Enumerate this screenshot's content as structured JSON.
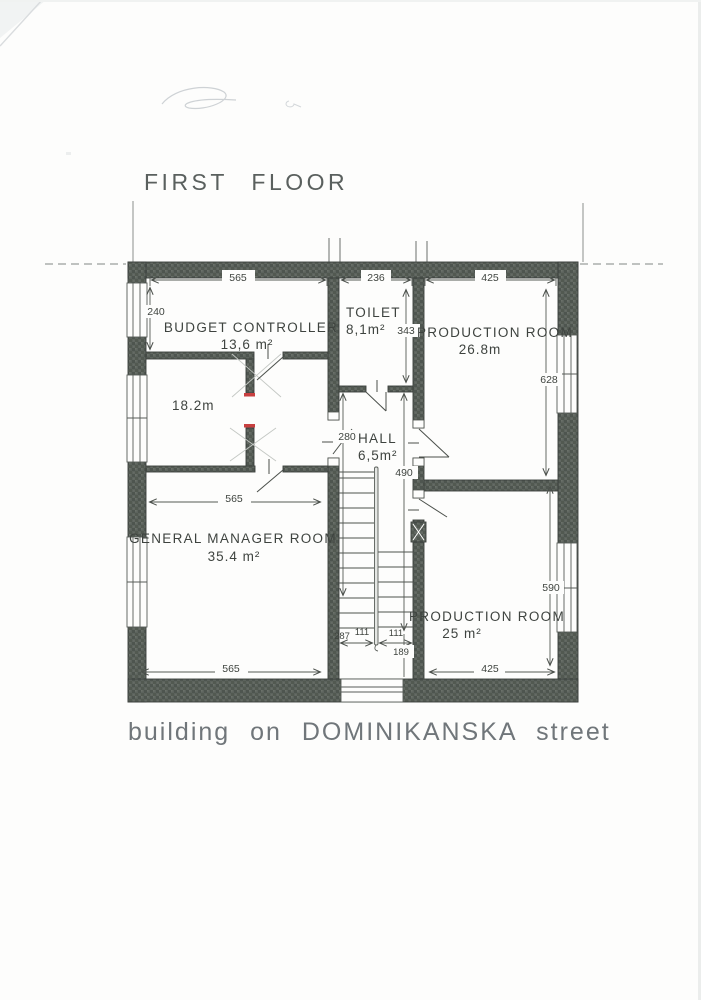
{
  "title": "FIRST FLOOR",
  "caption": "building on DOMINIKANSKA street",
  "rooms": {
    "budget_controller": {
      "name": "BUDGET CONTROLLER",
      "area": "13,6 m²"
    },
    "toilet": {
      "name": "TOILET",
      "area": "8,1m²"
    },
    "production_top": {
      "name": "PRODUCTION ROOM",
      "area": "26.8m"
    },
    "middle_room": {
      "area": "18.2m"
    },
    "hall": {
      "name": "HALL",
      "area": "6,5m²"
    },
    "general_manager": {
      "name": "GENERAL MANAGER ROOM",
      "area": "35.4 m²"
    },
    "production_bottom": {
      "name": "PRODUCTION ROOM",
      "area": "25 m²"
    }
  },
  "dimensions": {
    "top_left": "565",
    "top_middle": "236",
    "top_right": "425",
    "left_upper": "240",
    "toilet_height": "343",
    "right_upper": "628",
    "hall_left": "280",
    "hall_right": "490",
    "gm_width": "565",
    "right_lower": "590",
    "stair_run": "287",
    "stair_flight_left": "111",
    "stair_flight_right": "111",
    "lower_hall": "189",
    "bottom_left": "565",
    "bottom_right": "425"
  },
  "colors": {
    "wall": "#5c635d",
    "red_mark": "#c84040",
    "ink": "#454a46"
  }
}
